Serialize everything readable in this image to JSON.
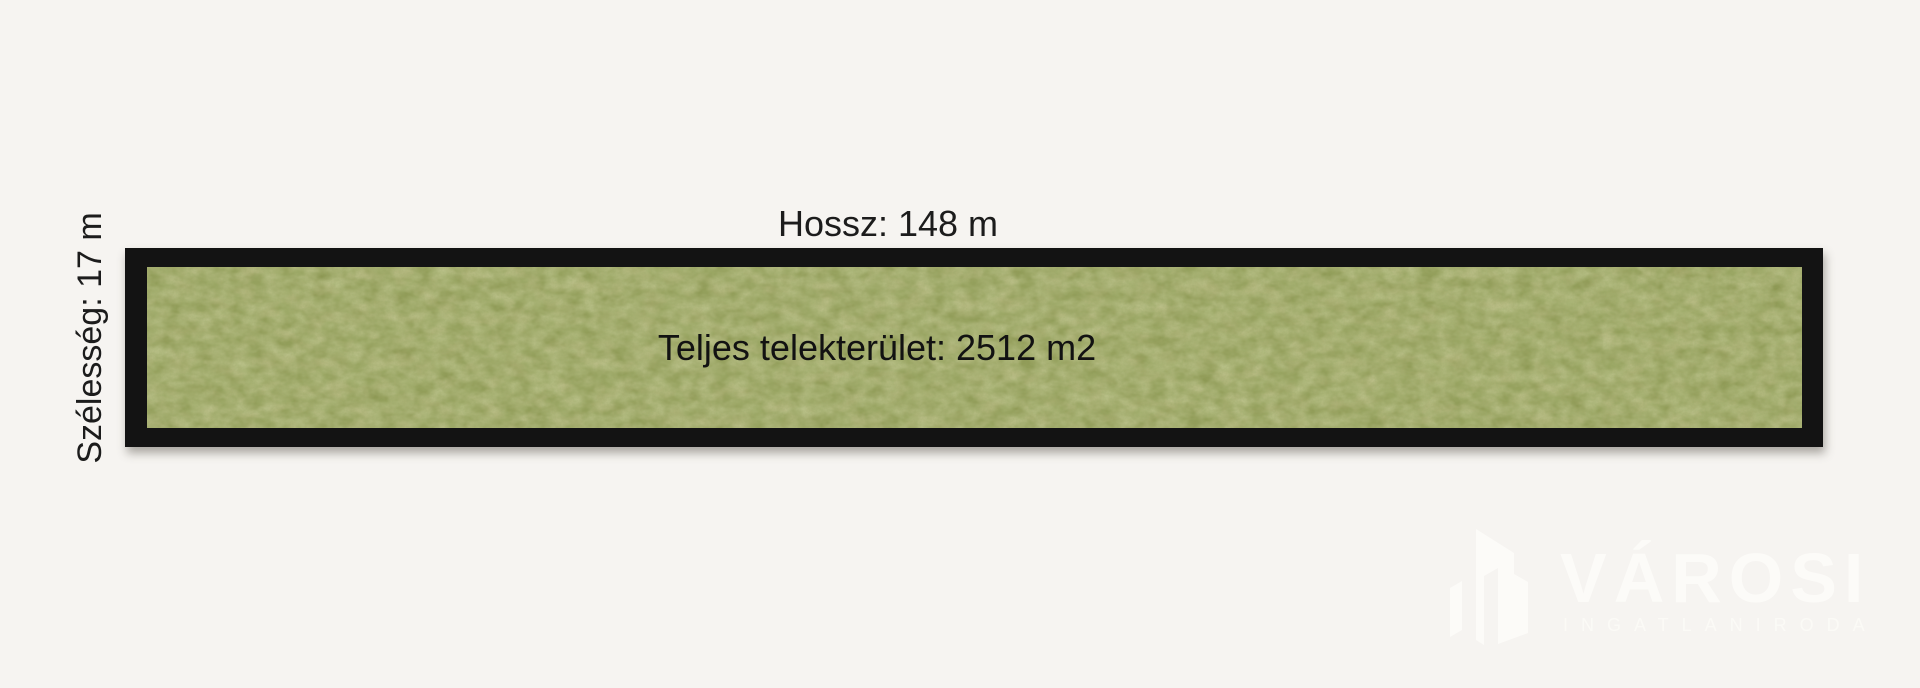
{
  "page": {
    "background_color": "#f6f4f1"
  },
  "diagram": {
    "length_label": "Hossz: 148 m",
    "width_label": "Szélesség: 17 m",
    "area_label": "Teljes telekterület: 2512 m2",
    "length_m": 148,
    "width_m": 17,
    "area_m2": 2512,
    "plot": {
      "border_color": "#131313",
      "grass_base_color": "#8c9651",
      "grass_dark_color": "#66782f",
      "grass_light_color": "#a5ab61",
      "grass_brown_color": "#9e8c4d"
    }
  },
  "watermark": {
    "brand": "VÁROSI",
    "tagline": "INGATLANIRODA",
    "color": "#fcfbf8",
    "icon": "buildings-icon"
  }
}
